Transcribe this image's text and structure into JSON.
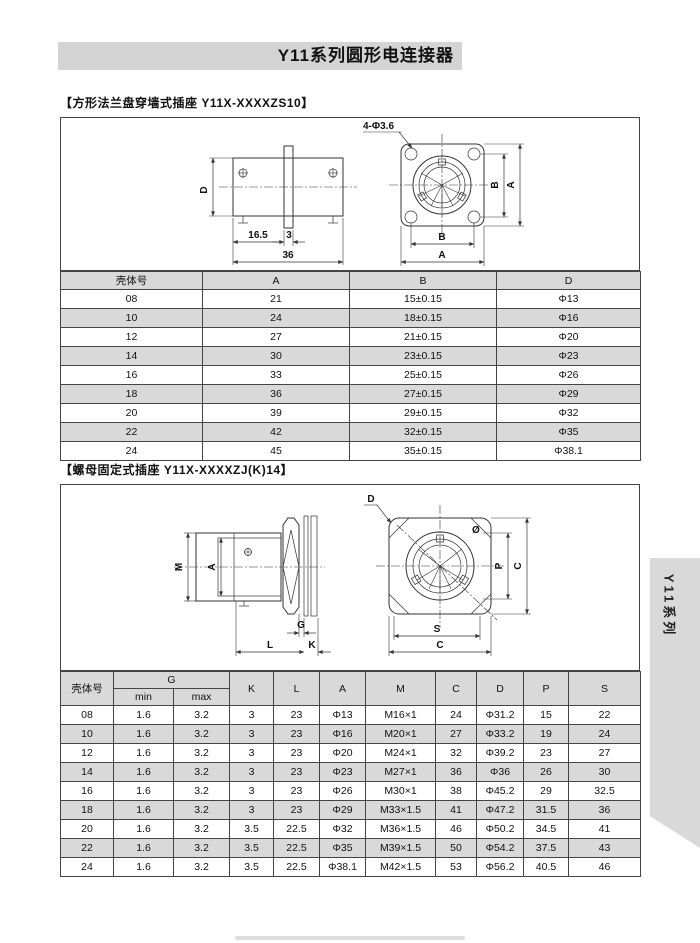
{
  "page": {
    "title": "Y11系列圆形电连接器",
    "side_tab": "Y11系列"
  },
  "section1": {
    "title": "【方形法兰盘穿墙式插座 Y11X-XXXXZS10】",
    "drawing_labels": {
      "hole_callout": "4-Φ3.6",
      "d": "D",
      "dim_16_5": "16.5",
      "dim_3": "3",
      "dim_36": "36",
      "b": "B",
      "a": "A"
    },
    "table": {
      "headers": [
        "壳体号",
        "A",
        "B",
        "D"
      ],
      "rows": [
        [
          "08",
          "21",
          "15±0.15",
          "Φ13"
        ],
        [
          "10",
          "24",
          "18±0.15",
          "Φ16"
        ],
        [
          "12",
          "27",
          "21±0.15",
          "Φ20"
        ],
        [
          "14",
          "30",
          "23±0.15",
          "Φ23"
        ],
        [
          "16",
          "33",
          "25±0.15",
          "Φ26"
        ],
        [
          "18",
          "36",
          "27±0.15",
          "Φ29"
        ],
        [
          "20",
          "39",
          "29±0.15",
          "Φ32"
        ],
        [
          "22",
          "42",
          "32±0.15",
          "Φ35"
        ],
        [
          "24",
          "45",
          "35±0.15",
          "Φ38.1"
        ]
      ]
    }
  },
  "section2": {
    "title": "【螺母固定式插座 Y11X-XXXXZJ(K)14】",
    "drawing_labels": {
      "m": "M",
      "a": "A",
      "d": "D",
      "g": "G",
      "l": "L",
      "k": "K",
      "diameter": "Ø",
      "p": "P",
      "c": "C",
      "s": "S"
    },
    "table": {
      "shell_header": "壳体号",
      "g_header": "G",
      "g_min": "min",
      "g_max": "max",
      "other_headers": [
        "K",
        "L",
        "A",
        "M",
        "C",
        "D",
        "P",
        "S"
      ],
      "rows": [
        [
          "08",
          "1.6",
          "3.2",
          "3",
          "23",
          "Φ13",
          "M16×1",
          "24",
          "Φ31.2",
          "15",
          "22"
        ],
        [
          "10",
          "1.6",
          "3.2",
          "3",
          "23",
          "Φ16",
          "M20×1",
          "27",
          "Φ33.2",
          "19",
          "24"
        ],
        [
          "12",
          "1.6",
          "3.2",
          "3",
          "23",
          "Φ20",
          "M24×1",
          "32",
          "Φ39.2",
          "23",
          "27"
        ],
        [
          "14",
          "1.6",
          "3.2",
          "3",
          "23",
          "Φ23",
          "M27×1",
          "36",
          "Φ36",
          "26",
          "30"
        ],
        [
          "16",
          "1.6",
          "3.2",
          "3",
          "23",
          "Φ26",
          "M30×1",
          "38",
          "Φ45.2",
          "29",
          "32.5"
        ],
        [
          "18",
          "1.6",
          "3.2",
          "3",
          "23",
          "Φ29",
          "M33×1.5",
          "41",
          "Φ47.2",
          "31.5",
          "36"
        ],
        [
          "20",
          "1.6",
          "3.2",
          "3.5",
          "22.5",
          "Φ32",
          "M36×1.5",
          "46",
          "Φ50.2",
          "34.5",
          "41"
        ],
        [
          "22",
          "1.6",
          "3.2",
          "3.5",
          "22.5",
          "Φ35",
          "M39×1.5",
          "50",
          "Φ54.2",
          "37.5",
          "43"
        ],
        [
          "24",
          "1.6",
          "3.2",
          "3.5",
          "22.5",
          "Φ38.1",
          "M42×1.5",
          "53",
          "Φ56.2",
          "40.5",
          "46"
        ]
      ]
    }
  },
  "colors": {
    "banner_bg": "#d4d4d4",
    "row_alt_bg": "#d9d9d9",
    "tab_bg": "#d9d9d9",
    "line": "#333333"
  }
}
